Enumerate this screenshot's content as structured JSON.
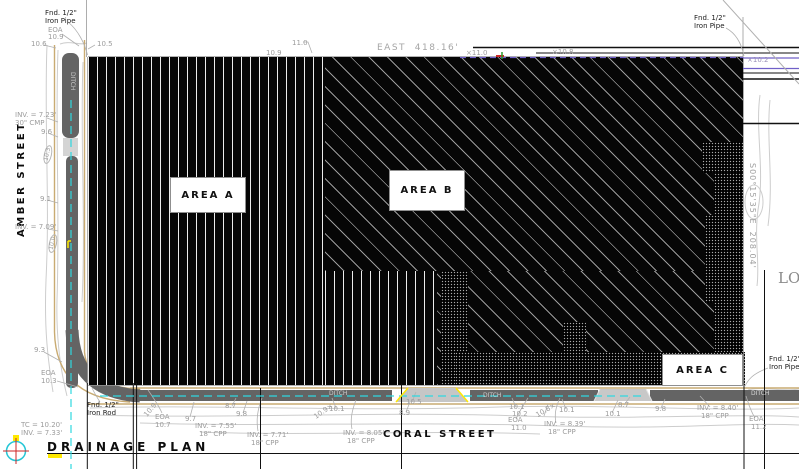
{
  "drawing": {
    "title": "DRAINAGE PLAN"
  },
  "streets": {
    "west": "AMBER STREET",
    "south": "CORAL STREET"
  },
  "boundaries": {
    "north_bearing": "EAST  418.16'",
    "east_bearing": "S00°15'35\"E  208.04'"
  },
  "areas": [
    {
      "label": "AREA A"
    },
    {
      "label": "AREA B"
    },
    {
      "label": "AREA C"
    }
  ],
  "adjacent_label": "LO",
  "colors": {
    "centerline_cyan": "#2fd8e0",
    "highlight_yellow": "#ffe900",
    "waterline_purple": "#7060c8",
    "compass_red": "#cc2626",
    "hatch_black": "#060606",
    "ditch_gray": "#646464",
    "edge_tan": "#c9ab72",
    "annotation_gray": "#9c9c9c"
  },
  "annotations": [
    {
      "t": "Fnd. 1/2\"",
      "x": 45,
      "y": 10,
      "c": "k"
    },
    {
      "t": "Iron Pipe",
      "x": 45,
      "y": 18,
      "c": "k"
    },
    {
      "t": "EOA",
      "x": 48,
      "y": 27
    },
    {
      "t": "10.9",
      "x": 48,
      "y": 34
    },
    {
      "t": "10.6",
      "x": 31,
      "y": 41
    },
    {
      "t": "10.5",
      "x": 97,
      "y": 41
    },
    {
      "t": "11.0",
      "x": 292,
      "y": 40
    },
    {
      "t": "10.9",
      "x": 266,
      "y": 50
    },
    {
      "t": "×11.0",
      "x": 466,
      "y": 50
    },
    {
      "t": "×10.8",
      "x": 552,
      "y": 49
    },
    {
      "t": "Fnd. 1/2\"",
      "x": 694,
      "y": 15,
      "c": "k"
    },
    {
      "t": "Iron Pipe",
      "x": 694,
      "y": 23,
      "c": "k"
    },
    {
      "t": "×10.2",
      "x": 747,
      "y": 57,
      "c": "#9a90b8"
    },
    {
      "t": "INV. = 7.23'",
      "x": 15,
      "y": 112
    },
    {
      "t": "30\" CMP",
      "x": 15,
      "y": 120
    },
    {
      "t": "9.6",
      "x": 41,
      "y": 129
    },
    {
      "t": "DITCH",
      "x": 75,
      "y": 72,
      "r": 90,
      "s": 6,
      "c": "#cfcfcf"
    },
    {
      "t": "10.3",
      "x": 42,
      "y": 163,
      "r": -78,
      "s": 6,
      "oval": true
    },
    {
      "t": "9.1",
      "x": 40,
      "y": 196
    },
    {
      "t": "INV. = 7.09'",
      "x": 15,
      "y": 224
    },
    {
      "t": "10.0",
      "x": 47,
      "y": 252,
      "r": -78,
      "s": 6,
      "oval": true
    },
    {
      "t": "LO",
      "x": 778,
      "y": 271,
      "s": 15,
      "f": "serif",
      "c": "#8a8a8a"
    },
    {
      "t": "9.3",
      "x": 34,
      "y": 347
    },
    {
      "t": "EOA",
      "x": 41,
      "y": 370
    },
    {
      "t": "10.3",
      "x": 41,
      "y": 378
    },
    {
      "t": "TC = 10.20'",
      "x": 21,
      "y": 422
    },
    {
      "t": "INV. = 7.33'",
      "x": 21,
      "y": 430
    },
    {
      "t": "Fnd. 1/2\"",
      "x": 87,
      "y": 402,
      "c": "k"
    },
    {
      "t": "Iron Rod",
      "x": 87,
      "y": 410,
      "c": "k"
    },
    {
      "t": "10.9",
      "x": 143,
      "y": 414,
      "r": -50
    },
    {
      "t": "EOA",
      "x": 155,
      "y": 414
    },
    {
      "t": "10.7",
      "x": 155,
      "y": 422
    },
    {
      "t": "9.7",
      "x": 185,
      "y": 416
    },
    {
      "t": "INV. = 7.55'",
      "x": 195,
      "y": 423
    },
    {
      "t": "18\" CPP",
      "x": 199,
      "y": 431
    },
    {
      "t": "8.7",
      "x": 225,
      "y": 403
    },
    {
      "t": "9.8",
      "x": 236,
      "y": 411
    },
    {
      "t": "INV. = 7.71'",
      "x": 247,
      "y": 432
    },
    {
      "t": "18\" CPP",
      "x": 251,
      "y": 440
    },
    {
      "t": "10.9×",
      "x": 313,
      "y": 415,
      "r": -35
    },
    {
      "t": "10.1",
      "x": 329,
      "y": 406
    },
    {
      "t": "DITCH",
      "x": 329,
      "y": 391,
      "s": 6,
      "c": "#cfcfcf"
    },
    {
      "t": "INV. = 8.05'",
      "x": 343,
      "y": 430
    },
    {
      "t": "18\" CPP",
      "x": 347,
      "y": 438
    },
    {
      "t": "10.5",
      "x": 406,
      "y": 399
    },
    {
      "t": "8.9",
      "x": 399,
      "y": 410
    },
    {
      "t": "DITCH",
      "x": 483,
      "y": 393,
      "s": 6,
      "c": "#cfcfcf"
    },
    {
      "t": "10.1",
      "x": 509,
      "y": 404
    },
    {
      "t": "10.2",
      "x": 512,
      "y": 411
    },
    {
      "t": "EOA",
      "x": 508,
      "y": 417
    },
    {
      "t": "11.0",
      "x": 511,
      "y": 425
    },
    {
      "t": "10.8×",
      "x": 535,
      "y": 413,
      "r": -30
    },
    {
      "t": "10.1",
      "x": 559,
      "y": 407
    },
    {
      "t": "INV. = 8.39'",
      "x": 544,
      "y": 421
    },
    {
      "t": "18\" CPP",
      "x": 548,
      "y": 429
    },
    {
      "t": "10.1",
      "x": 605,
      "y": 411
    },
    {
      "t": "8.7",
      "x": 618,
      "y": 402
    },
    {
      "t": "9.8",
      "x": 655,
      "y": 406
    },
    {
      "t": "INV. = 8.40'",
      "x": 697,
      "y": 405
    },
    {
      "t": "18\" CPP",
      "x": 701,
      "y": 413
    },
    {
      "t": "Fnd. 1/2\"",
      "x": 769,
      "y": 356,
      "c": "k"
    },
    {
      "t": "Iron Pipe",
      "x": 769,
      "y": 364,
      "c": "k"
    },
    {
      "t": "DITCH",
      "x": 751,
      "y": 391,
      "s": 6,
      "c": "#d8d8d8"
    },
    {
      "t": "EOA",
      "x": 749,
      "y": 416
    },
    {
      "t": "11.2",
      "x": 751,
      "y": 424
    }
  ]
}
